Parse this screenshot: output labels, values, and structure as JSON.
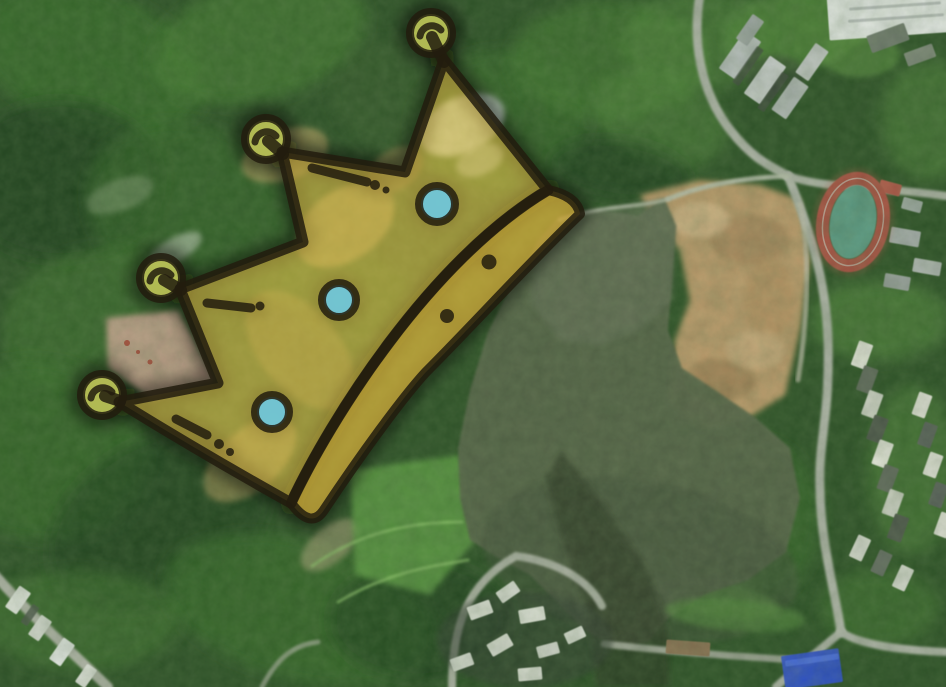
{
  "meta": {
    "description": "Satellite aerial map of a forested hillside, reservoir lake and urban edge, with a hand-drawn golden crown overlay marking a hilltop site",
    "width": 946,
    "height": 687
  },
  "palette": {
    "base": "#2c5026",
    "g1": "#1f3d1b",
    "g2": "#386c2c",
    "g3": "#447a31",
    "g4": "#52883c",
    "g5": "#5e9747",
    "g6": "#3a5e2e",
    "road": "#aeb3a8",
    "roadL": "#b9bfae",
    "white": "#e3e7e4",
    "gray": "#b9bfbf",
    "dkroof": "#5f675c",
    "water": "#566349",
    "dirt": "#c49f70"
  },
  "map": {
    "forest_blobs": [
      {
        "x": 90,
        "y": 60,
        "rx": 120,
        "ry": 70,
        "r": 20,
        "c": "g2",
        "o": 0.8
      },
      {
        "x": 260,
        "y": 40,
        "rx": 110,
        "ry": 60,
        "r": -15,
        "c": "g3",
        "o": 0.7
      },
      {
        "x": 420,
        "y": 100,
        "rx": 90,
        "ry": 60,
        "r": 10,
        "c": "g6",
        "o": 0.5
      },
      {
        "x": 60,
        "y": 180,
        "rx": 100,
        "ry": 80,
        "r": 0,
        "c": "g1",
        "o": 0.7
      },
      {
        "x": 200,
        "y": 220,
        "rx": 120,
        "ry": 90,
        "r": 30,
        "c": "g2",
        "o": 0.55
      },
      {
        "x": 90,
        "y": 320,
        "rx": 90,
        "ry": 70,
        "r": -20,
        "c": "g3",
        "o": 0.5
      },
      {
        "x": 40,
        "y": 450,
        "rx": 110,
        "ry": 90,
        "r": 10,
        "c": "g2",
        "o": 0.7
      },
      {
        "x": 160,
        "y": 520,
        "rx": 120,
        "ry": 80,
        "r": -30,
        "c": "g1",
        "o": 0.6
      },
      {
        "x": 300,
        "y": 610,
        "rx": 140,
        "ry": 70,
        "r": 15,
        "c": "g2",
        "o": 0.7
      },
      {
        "x": 80,
        "y": 620,
        "rx": 100,
        "ry": 50,
        "r": 0,
        "c": "g3",
        "o": 0.5
      },
      {
        "x": 230,
        "y": 400,
        "rx": 80,
        "ry": 60,
        "r": 0,
        "c": "g6",
        "o": 0.5
      },
      {
        "x": 350,
        "y": 300,
        "rx": 70,
        "ry": 50,
        "r": 20,
        "c": "g2",
        "o": 0.4
      },
      {
        "x": 500,
        "y": 120,
        "rx": 90,
        "ry": 70,
        "r": -10,
        "c": "g2",
        "o": 0.6
      },
      {
        "x": 610,
        "y": 60,
        "rx": 100,
        "ry": 60,
        "r": 0,
        "c": "g3",
        "o": 0.6
      },
      {
        "x": 660,
        "y": 120,
        "rx": 70,
        "ry": 45,
        "r": 20,
        "c": "g4",
        "o": 0.5
      },
      {
        "x": 700,
        "y": 40,
        "rx": 80,
        "ry": 50,
        "r": 0,
        "c": "g4",
        "o": 0.5
      },
      {
        "x": 420,
        "y": 620,
        "rx": 90,
        "ry": 60,
        "r": 0,
        "c": "g1",
        "o": 0.6
      },
      {
        "x": 880,
        "y": 320,
        "rx": 70,
        "ry": 40,
        "r": 0,
        "c": "g4",
        "o": 0.6
      },
      {
        "x": 912,
        "y": 470,
        "rx": 45,
        "ry": 85,
        "r": 0,
        "c": "g4",
        "o": 0.5
      },
      {
        "x": 760,
        "y": 520,
        "rx": 60,
        "ry": 80,
        "r": 0,
        "c": "g2",
        "o": 0.6
      },
      {
        "x": 880,
        "y": 608,
        "rx": 60,
        "ry": 38,
        "r": 0,
        "c": "g3",
        "o": 0.5
      },
      {
        "x": 790,
        "y": 30,
        "rx": 70,
        "ry": 40,
        "r": -10,
        "c": "g5",
        "o": 0.45
      },
      {
        "x": 930,
        "y": 120,
        "rx": 50,
        "ry": 60,
        "r": 0,
        "c": "g4",
        "o": 0.5
      },
      {
        "x": 620,
        "y": 170,
        "rx": 70,
        "ry": 30,
        "r": 8,
        "c": "g1",
        "o": 0.6
      }
    ],
    "patches": [
      {
        "x": 462,
        "y": 125,
        "rx": 45,
        "ry": 28,
        "r": -25,
        "c": "#c9d2cf",
        "o": 0.85,
        "n": "bare-rock-patch"
      },
      {
        "x": 480,
        "y": 160,
        "rx": 25,
        "ry": 15,
        "r": -25,
        "c": "#b9c4bd",
        "o": 0.6,
        "n": "bare-rock-patch"
      },
      {
        "x": 285,
        "y": 155,
        "rx": 45,
        "ry": 25,
        "r": -20,
        "c": "#c4a76b",
        "o": 0.6,
        "n": "bare-soil-patch"
      },
      {
        "x": 345,
        "y": 225,
        "rx": 55,
        "ry": 35,
        "r": -35,
        "c": "#caa96a",
        "o": 0.55,
        "n": "bare-soil-patch"
      },
      {
        "x": 395,
        "y": 170,
        "rx": 30,
        "ry": 20,
        "r": -35,
        "c": "#b99a5e",
        "o": 0.5,
        "n": "bare-soil-patch"
      },
      {
        "x": 250,
        "y": 460,
        "rx": 55,
        "ry": 30,
        "r": -40,
        "c": "#c7a467",
        "o": 0.5,
        "n": "bare-soil-patch"
      },
      {
        "x": 300,
        "y": 350,
        "rx": 40,
        "ry": 70,
        "r": -40,
        "c": "#b99a58",
        "o": 0.35,
        "n": "bare-soil-patch"
      },
      {
        "x": 330,
        "y": 545,
        "rx": 35,
        "ry": 18,
        "r": -40,
        "c": "#bfae8a",
        "o": 0.5,
        "n": "bare-soil-patch"
      },
      {
        "x": 175,
        "y": 250,
        "rx": 30,
        "ry": 12,
        "r": -30,
        "c": "#cfd6c9",
        "o": 0.55,
        "n": "pale-clearing"
      },
      {
        "x": 120,
        "y": 195,
        "rx": 35,
        "ry": 16,
        "r": -20,
        "c": "#9fb08e",
        "o": 0.4,
        "n": "pale-clearing"
      },
      {
        "pts": "106,318 178,310 216,382 152,400 108,368",
        "c": "#c6a28f",
        "o": 0.92,
        "n": "pink-bare-land"
      },
      {
        "pts": "350,470 460,455 475,540 430,595 355,575",
        "c": "#5f9e44",
        "o": 0.8,
        "n": "grass-field"
      },
      {
        "x": 720,
        "y": 600,
        "rx": 60,
        "ry": 18,
        "r": 10,
        "c": "#5d9a43",
        "o": 0.7,
        "n": "grass-shore"
      },
      {
        "x": 800,
        "y": 30,
        "rx": 70,
        "ry": 38,
        "r": -10,
        "c": "#4a7b36",
        "o": 0.85,
        "n": "lawn-roof"
      },
      {
        "x": 860,
        "y": 55,
        "rx": 40,
        "ry": 22,
        "r": 0,
        "c": "#55883c",
        "o": 0.7,
        "n": "lawn-roof"
      }
    ],
    "red_marks": [
      {
        "x": 127,
        "y": 343,
        "r": 3
      },
      {
        "x": 150,
        "y": 362,
        "r": 2.5
      },
      {
        "x": 138,
        "y": 352,
        "r": 2
      }
    ],
    "dirt_main": {
      "pts": "640,195 700,180 760,185 800,200 810,260 800,330 785,395 745,420 700,430 668,400 675,340 690,300 680,250 655,225",
      "c": "#c49f70",
      "o": 0.95
    },
    "dirt_spots": [
      {
        "x": 750,
        "y": 240,
        "rx": 40,
        "ry": 25,
        "r": 0,
        "c": "#9a7a52",
        "o": 0.5
      },
      {
        "x": 720,
        "y": 380,
        "rx": 35,
        "ry": 22,
        "r": 0,
        "c": "#8f7049",
        "o": 0.5
      },
      {
        "x": 770,
        "y": 300,
        "rx": 25,
        "ry": 40,
        "r": 0,
        "c": "#b08a5c",
        "o": 0.45
      },
      {
        "x": 700,
        "y": 220,
        "rx": 30,
        "ry": 18,
        "r": 0,
        "c": "#d8bd92",
        "o": 0.6
      },
      {
        "x": 755,
        "y": 350,
        "rx": 30,
        "ry": 20,
        "r": 0,
        "c": "#d2b588",
        "o": 0.5
      }
    ],
    "lake": {
      "points": "560,216 600,210 638,216 664,198 676,226 672,282 668,330 682,368 718,392 756,418 790,448 800,498 786,552 748,580 706,594 668,618 648,642 615,648 585,630 560,605 530,575 495,556 470,540 460,498 458,448 470,390 488,332 512,284 538,242",
      "color": "#566349",
      "upper_tint": {
        "pts": "560,216 664,198 676,226 672,300 640,330 600,345 560,340 530,300 538,242",
        "c": "#68725c",
        "o": 0.6
      },
      "deep_tint": {
        "x": 640,
        "y": 560,
        "rx": 160,
        "ry": 80,
        "r": 10,
        "c": "#43503a",
        "o": 0.5
      },
      "shadow": {
        "pts": "562,452 606,508 648,572 668,628 670,687 596,687 588,612 560,532 545,478",
        "c": "#2b3424",
        "o": 0.6
      }
    },
    "roads": [
      {
        "d": "M700,-5 C692,40 700,92 731,131 C753,159 770,166 788,176",
        "w": 9,
        "c": "road"
      },
      {
        "d": "M788,176 C830,190 880,186 946,196",
        "w": 8,
        "c": "road"
      },
      {
        "d": "M788,176 C810,230 826,280 828,340 C830,420 818,440 820,490 C821,545 834,585 841,632",
        "w": 9,
        "c": "road"
      },
      {
        "d": "M841,632 C860,645 900,650 946,652",
        "w": 8,
        "c": "road"
      },
      {
        "d": "M841,632 C820,650 800,665 776,687",
        "w": 8,
        "c": "road"
      },
      {
        "d": "M560,220 C600,205 640,208 668,199",
        "w": 4,
        "c": "roadL",
        "o": 0.8
      },
      {
        "d": "M668,199 C700,186 740,178 788,176",
        "w": 5,
        "c": "roadL",
        "o": 0.9
      },
      {
        "d": "M800,205 C812,260 806,330 798,380",
        "w": 5,
        "c": "#c2bfae",
        "o": 0.7
      },
      {
        "d": "M452,687 C452,628 466,584 516,556 C560,562 590,582 602,606",
        "w": 8,
        "c": "#aaafa3"
      },
      {
        "d": "M604,644 C660,650 720,656 800,660",
        "w": 7,
        "c": "#9aa092"
      },
      {
        "d": "M-5,575 C30,615 70,650 108,687",
        "w": 10,
        "c": "#b0b4a8"
      },
      {
        "d": "M262,687 C276,660 292,645 318,642",
        "w": 5,
        "c": "#a9ae9f",
        "o": 0.7
      },
      {
        "d": "M312,566 C360,532 410,522 462,522",
        "w": 3,
        "c": "#8cc06a",
        "o": 0.7
      },
      {
        "d": "M338,602 C388,572 432,566 468,560",
        "w": 3,
        "c": "#8cc06a",
        "o": 0.7
      }
    ],
    "shades": [
      {
        "x": 525,
        "y": 640,
        "rx": 88,
        "ry": 48,
        "r": 0,
        "c": "#333d30",
        "o": 0.55,
        "n": "village-ground"
      },
      {
        "x": 775,
        "y": 75,
        "rx": 30,
        "ry": 20,
        "r": 0,
        "c": "#2f3a2f",
        "o": 0.5,
        "n": "courtyard-shadow"
      },
      {
        "x": 735,
        "y": 615,
        "rx": 70,
        "ry": 16,
        "r": 5,
        "c": "#52883c",
        "o": 0.6,
        "n": "grass-shore"
      }
    ],
    "buildings": [
      {
        "x": 893,
        "y": 14,
        "w": 130,
        "h": 44,
        "r": -4,
        "c": "white",
        "n": "warehouse-roof"
      },
      {
        "x": 895,
        "y": 6,
        "w": 92,
        "h": 3,
        "r": -4,
        "c": "#b7bdbb"
      },
      {
        "x": 896,
        "y": 18,
        "w": 96,
        "h": 3,
        "r": -4,
        "c": "#b7bdbb"
      },
      {
        "x": 740,
        "y": 55,
        "w": 46,
        "h": 20,
        "r": -55,
        "c": "gray",
        "n": "apartment-block"
      },
      {
        "x": 765,
        "y": 80,
        "w": 46,
        "h": 20,
        "r": -55,
        "c": "#c4c9c7",
        "n": "apartment-block"
      },
      {
        "x": 790,
        "y": 98,
        "w": 40,
        "h": 18,
        "r": -55,
        "c": "#aeb5b3",
        "n": "apartment-block"
      },
      {
        "x": 812,
        "y": 62,
        "w": 36,
        "h": 16,
        "r": -55,
        "c": "#c0c5c3",
        "n": "apartment-block"
      },
      {
        "x": 750,
        "y": 30,
        "w": 30,
        "h": 14,
        "r": -55,
        "c": "#9ba3a1",
        "n": "apartment-block"
      },
      {
        "x": 748,
        "y": 66,
        "w": 44,
        "h": 8,
        "r": -55,
        "c": "#3f473f",
        "o": 0.7
      },
      {
        "x": 773,
        "y": 92,
        "w": 44,
        "h": 8,
        "r": -55,
        "c": "#3f473f",
        "o": 0.7
      },
      {
        "x": 888,
        "y": 38,
        "w": 40,
        "h": 18,
        "r": -20,
        "c": "#6f7a6e",
        "n": "building"
      },
      {
        "x": 920,
        "y": 55,
        "w": 30,
        "h": 14,
        "r": -20,
        "c": "#7d8779",
        "n": "building"
      },
      {
        "x": 890,
        "y": 188,
        "w": 22,
        "h": 12,
        "r": 15,
        "c": "#b35648",
        "n": "school-building"
      },
      {
        "x": 912,
        "y": 205,
        "w": 20,
        "h": 12,
        "r": 15,
        "c": "#9aa59e",
        "n": "school-building"
      },
      {
        "x": 905,
        "y": 237,
        "w": 30,
        "h": 16,
        "r": 10,
        "c": "#a8aeae",
        "n": "building"
      },
      {
        "x": 927,
        "y": 267,
        "w": 28,
        "h": 14,
        "r": 10,
        "c": "#b2b8b6",
        "n": "building"
      },
      {
        "x": 897,
        "y": 282,
        "w": 26,
        "h": 14,
        "r": 10,
        "c": "#9aa19f",
        "n": "building"
      },
      {
        "x": 688,
        "y": 648,
        "w": 44,
        "h": 14,
        "r": 4,
        "c": "#8a6f52",
        "n": "bridge-causeway"
      },
      {
        "x": 812,
        "y": 669,
        "w": 58,
        "h": 34,
        "r": -8,
        "c": "#2d50cd",
        "o": 0.95,
        "n": "blue-roof-building"
      },
      {
        "x": 812,
        "y": 660,
        "w": 54,
        "h": 6,
        "r": -8,
        "c": "#4a6de0",
        "o": 0.9
      },
      {
        "x": 18,
        "y": 600,
        "w": 26,
        "h": 14,
        "r": -55,
        "c": "#dfe3dc",
        "n": "building"
      },
      {
        "x": 40,
        "y": 628,
        "w": 24,
        "h": 13,
        "r": -55,
        "c": "#d6dad2",
        "n": "building"
      },
      {
        "x": 62,
        "y": 652,
        "w": 26,
        "h": 14,
        "r": -55,
        "c": "white",
        "n": "building"
      },
      {
        "x": 86,
        "y": 676,
        "w": 22,
        "h": 12,
        "r": -55,
        "c": "#d8dcd4",
        "n": "building"
      },
      {
        "x": 30,
        "y": 615,
        "w": 22,
        "h": 8,
        "r": -55,
        "c": "#4a524a",
        "o": 0.8
      },
      {
        "x": 480,
        "y": 610,
        "w": 24,
        "h": 14,
        "r": -20,
        "c": "#dcdfd6",
        "n": "village-house"
      },
      {
        "x": 508,
        "y": 592,
        "w": 22,
        "h": 13,
        "r": -35,
        "c": "#d4d8cf",
        "n": "village-house"
      },
      {
        "x": 532,
        "y": 615,
        "w": 26,
        "h": 14,
        "r": -10,
        "c": "#e0e3da",
        "n": "village-house"
      },
      {
        "x": 500,
        "y": 645,
        "w": 24,
        "h": 14,
        "r": -30,
        "c": "#d8dbd2",
        "n": "village-house"
      },
      {
        "x": 548,
        "y": 650,
        "w": 22,
        "h": 12,
        "r": -15,
        "c": "#cfd3ca",
        "n": "village-house"
      },
      {
        "x": 575,
        "y": 635,
        "w": 20,
        "h": 12,
        "r": -25,
        "c": "#d8dcd3",
        "n": "village-house"
      },
      {
        "x": 462,
        "y": 662,
        "w": 22,
        "h": 13,
        "r": -20,
        "c": "#d2d6cd",
        "n": "village-house"
      },
      {
        "x": 530,
        "y": 674,
        "w": 24,
        "h": 13,
        "r": -5,
        "c": "#daddd4",
        "n": "village-house"
      }
    ],
    "house_rows": [
      {
        "x1": 862,
        "y1": 355,
        "x2": 898,
        "y2": 528,
        "n": 8,
        "w": 26,
        "h": 15,
        "r": -70,
        "colors": [
          "#e4e5db",
          "#5f675c",
          "#cfd2c7",
          "#4d564c"
        ]
      },
      {
        "x1": 922,
        "y1": 405,
        "x2": 944,
        "y2": 525,
        "n": 5,
        "w": 24,
        "h": 14,
        "r": -70,
        "colors": [
          "#dfe0d6",
          "#59615a"
        ]
      },
      {
        "x1": 860,
        "y1": 548,
        "x2": 903,
        "y2": 578,
        "n": 3,
        "w": 24,
        "h": 14,
        "r": -65,
        "colors": [
          "#d8dbd2",
          "#646c62",
          "#d2d6cc"
        ]
      }
    ],
    "track": {
      "cx": 853,
      "cy": 222,
      "rx": 30,
      "ry": 44,
      "rot": 10,
      "pad_color": "#b65948",
      "track_color": "#a85043",
      "field_color": "#5b9a85",
      "lane_color": "#c9cfc5"
    }
  },
  "crown": {
    "fill": "rgba(237,201,77,0.55)",
    "band_fill": "rgba(222,183,62,0.72)",
    "outline": "rgba(34,28,14,0.85)",
    "halo": "rgba(12,14,6,0.45)",
    "ball_fill": "#b8c156",
    "gem_fill": "#70c6d8",
    "body_path": "M548,190 L444,60 L405,172 L282,152 L303,242 L180,289 L218,383 L119,402 Q205,455 291,503 C330,420 430,260 548,190 Z",
    "band_path": "M548,190 Q577,196 580,214 C532,260 472,326 426,372 C402,398 360,456 324,510 Q311,530 291,503 C330,420 430,260 548,190 Z",
    "stems": [
      [
        444,
        62,
        432,
        37
      ],
      [
        283,
        154,
        268,
        141
      ],
      [
        181,
        290,
        164,
        280
      ],
      [
        120,
        401,
        105,
        396
      ]
    ],
    "balls": [
      {
        "x": 431,
        "y": 33
      },
      {
        "x": 266,
        "y": 139
      },
      {
        "x": 161,
        "y": 278
      },
      {
        "x": 102,
        "y": 395
      }
    ],
    "ball_arc": "M -11 3 A 12 12 0 0 1 10 -3",
    "gems": [
      {
        "x": 437,
        "y": 204,
        "r": 16
      },
      {
        "x": 339,
        "y": 300,
        "r": 15
      },
      {
        "x": 272,
        "y": 412,
        "r": 15
      }
    ],
    "dashes": [
      {
        "x1": 312,
        "y1": 168,
        "x2": 367,
        "y2": 182
      },
      {
        "x1": 207,
        "y1": 303,
        "x2": 251,
        "y2": 308
      },
      {
        "x1": 176,
        "y1": 419,
        "x2": 207,
        "y2": 435
      }
    ],
    "dots": [
      {
        "x": 375,
        "y": 185,
        "r": 5
      },
      {
        "x": 386,
        "y": 190,
        "r": 3.5
      },
      {
        "x": 260,
        "y": 306,
        "r": 4.5
      },
      {
        "x": 219,
        "y": 444,
        "r": 5
      },
      {
        "x": 230,
        "y": 452,
        "r": 4
      },
      {
        "x": 489,
        "y": 262,
        "r": 7.5
      },
      {
        "x": 447,
        "y": 316,
        "r": 7
      }
    ]
  }
}
